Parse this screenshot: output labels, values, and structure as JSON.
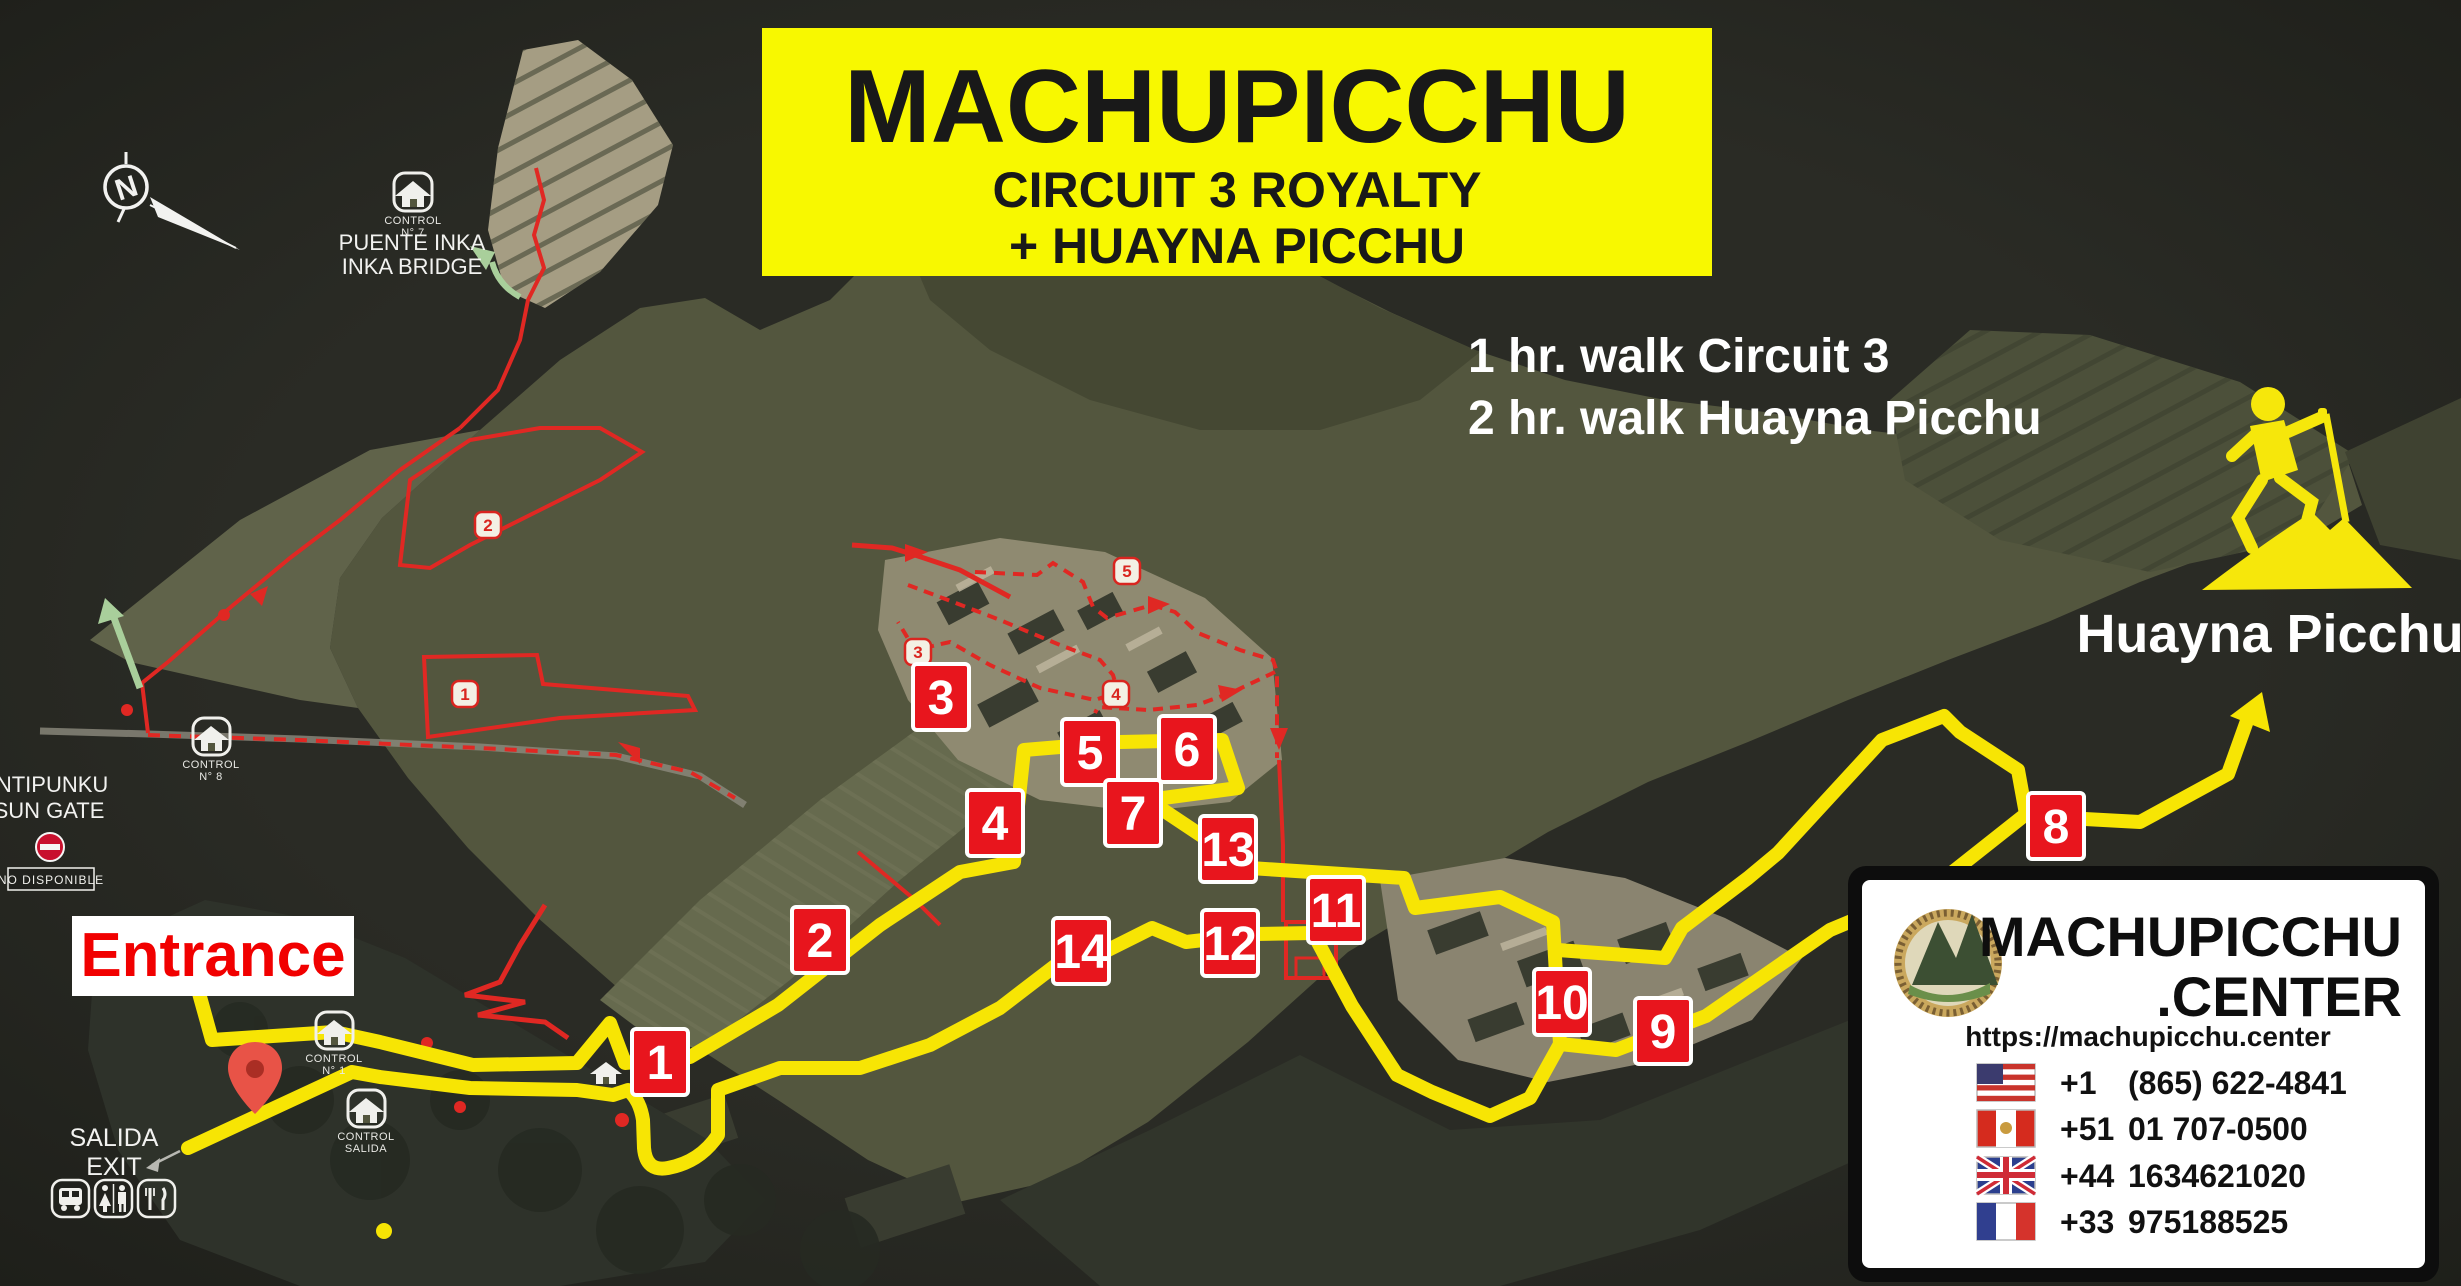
{
  "title": {
    "line1": "MACHUPICCHU",
    "line2": "CIRCUIT 3 ROYALTY",
    "line3": "+ HUAYNA PICCHU"
  },
  "walk_info": {
    "line1": "1 hr. walk Circuit 3",
    "line2": "2 hr. walk Huayna Picchu"
  },
  "labels": {
    "huayna_picchu": "Huayna Picchu",
    "entrance": "Entrance",
    "salida": "SALIDA",
    "exit": "EXIT",
    "intipunku": "INTIPUNKU",
    "sun_gate": "SUN GATE",
    "no_disponible": "NO DISPONIBLE",
    "puente_inka": "PUENTE INKA",
    "inka_bridge": "INKA BRIDGE",
    "compass_north": "N"
  },
  "controls": [
    {
      "line1": "CONTROL",
      "line2": "N° 7"
    },
    {
      "line1": "CONTROL",
      "line2": "N° 8"
    },
    {
      "line1": "CONTROL",
      "line2": "N° 1"
    },
    {
      "line1": "CONTROL",
      "line2": "SALIDA"
    }
  ],
  "markers": {
    "big": [
      "1",
      "2",
      "3",
      "4",
      "5",
      "6",
      "7",
      "8",
      "9",
      "10",
      "11",
      "12",
      "13",
      "14"
    ],
    "small": [
      "1",
      "2",
      "3",
      "4",
      "5"
    ]
  },
  "info_box": {
    "brand_line1": "MACHUPICCHU",
    "brand_line2": ".CENTER",
    "url": "https://machupicchu.center",
    "phones": [
      {
        "flag": "us-flag-icon",
        "code": "+1",
        "number": "(865) 622-4841"
      },
      {
        "flag": "pe-flag-icon",
        "code": "+51",
        "number": "01 707-0500"
      },
      {
        "flag": "uk-flag-icon",
        "code": "+44",
        "number": "1634621020"
      },
      {
        "flag": "fr-flag-icon",
        "code": "+33",
        "number": "975188525"
      }
    ]
  },
  "colors": {
    "route_yellow": "#f7e504",
    "circuit_red": "#e02823",
    "marker_red": "#e8151d",
    "title_bg": "#f8f800",
    "entrance_red": "#f10000",
    "map_bg": "#242521"
  }
}
